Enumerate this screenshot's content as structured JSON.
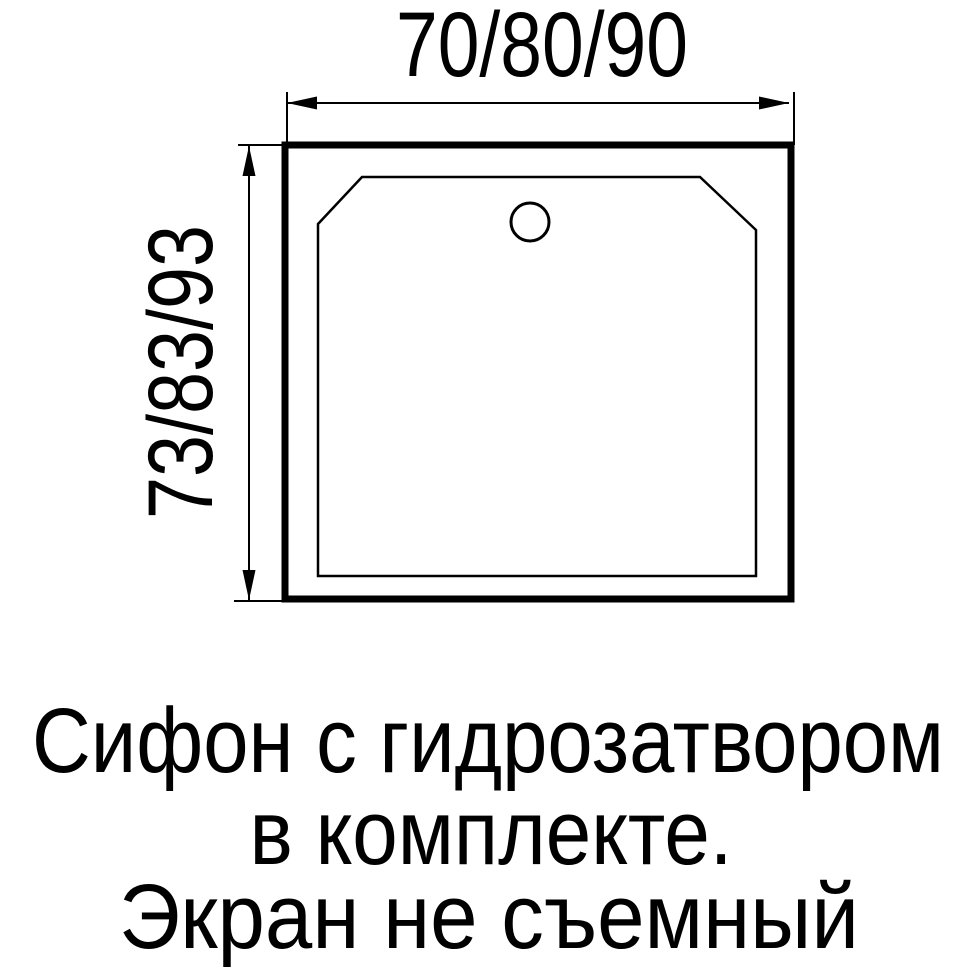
{
  "diagram": {
    "title": "shower-tray-top-view",
    "top_dimension": "70/80/90",
    "left_dimension": "73/83/93"
  },
  "note": {
    "line1": "Сифон с гидрозатвором",
    "line2": "в комплекте.",
    "line3": "Экран не съемный"
  },
  "icons": {
    "drain_hole": "circle"
  },
  "colors": {
    "line": "#000000",
    "text": "#000000",
    "background": "#ffffff"
  }
}
